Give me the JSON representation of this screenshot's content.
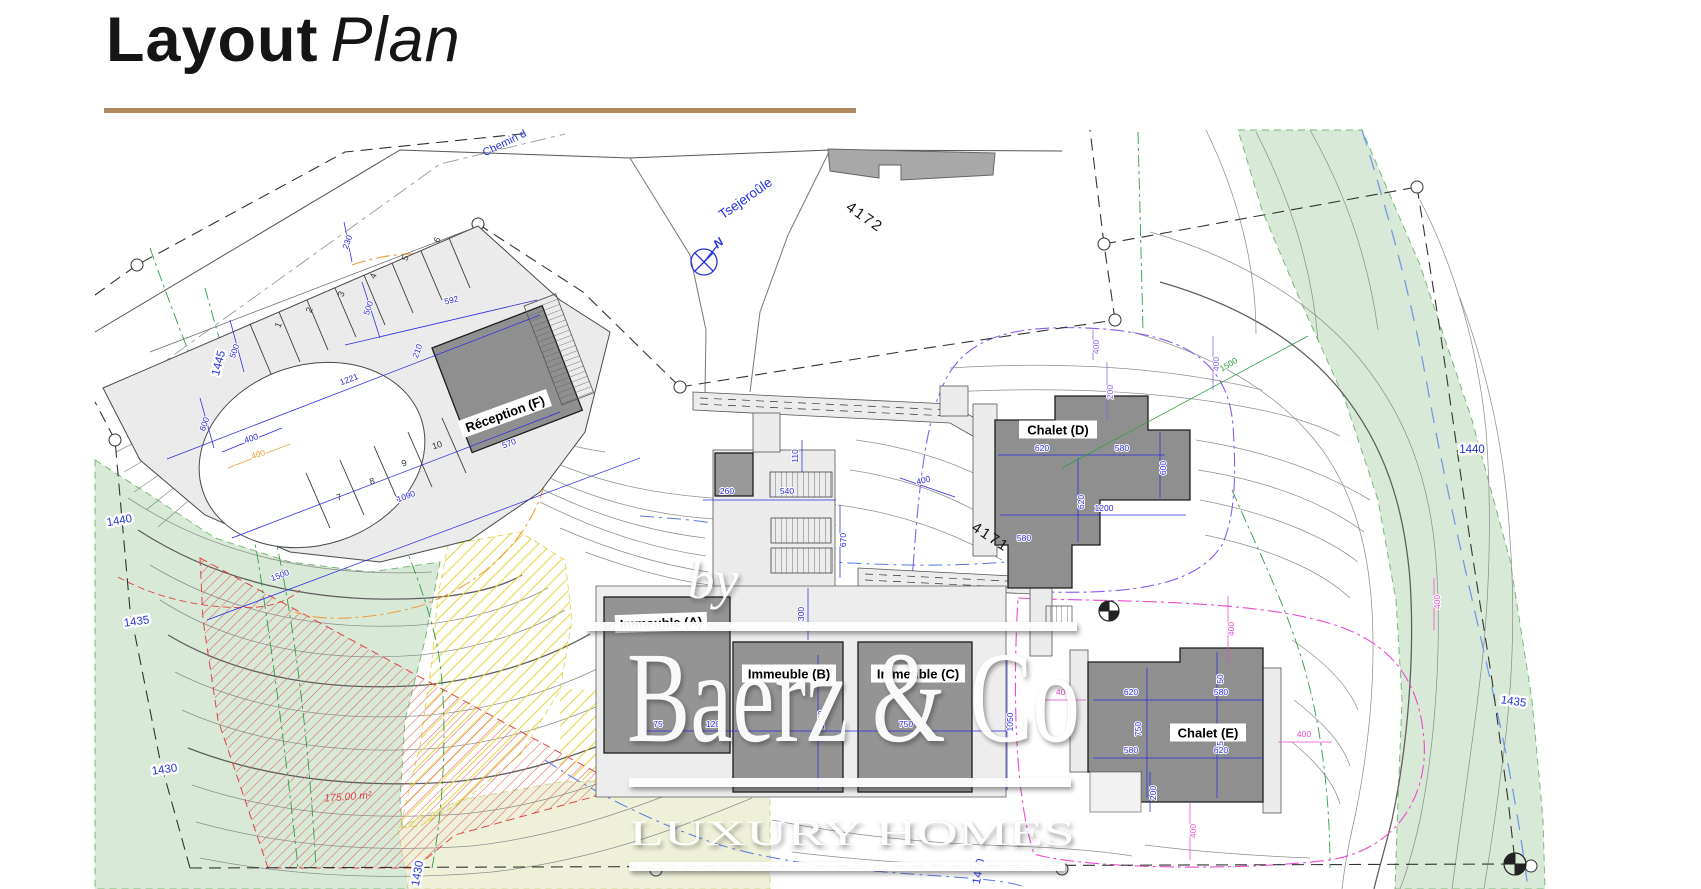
{
  "title": {
    "main": "Layout",
    "sub": "Plan"
  },
  "watermark": {
    "by": "by",
    "name": "Baerz & Co",
    "tagline": "LUXURY HOMES"
  },
  "map": {
    "street_label": "Chemin d",
    "place_label": "Tsejeroûle",
    "compass_label": "N",
    "area_label": "175.00 m²",
    "parcel_numbers": [
      {
        "t": "4172",
        "x": 862,
        "y": 221,
        "r": 35
      },
      {
        "t": "4171",
        "x": 988,
        "y": 541,
        "r": 33
      }
    ],
    "building_labels": [
      {
        "t": "Réception (F)",
        "x": 505,
        "y": 414,
        "r": -20,
        "w": 94
      },
      {
        "t": "Chalet (D)",
        "x": 1058,
        "y": 430,
        "r": 0,
        "w": 78
      },
      {
        "t": "Chalet (E)",
        "x": 1208,
        "y": 733,
        "r": 0,
        "w": 76
      },
      {
        "t": "Immeuble (A)",
        "x": 661,
        "y": 623,
        "r": -2,
        "w": 92
      },
      {
        "t": "Immeuble (B)",
        "x": 789,
        "y": 674,
        "r": 0,
        "w": 94
      },
      {
        "t": "Immeuble (C)",
        "x": 918,
        "y": 674,
        "r": 0,
        "w": 94
      }
    ],
    "contour_labels": [
      {
        "t": "1445",
        "x": 222,
        "y": 364,
        "r": -75
      },
      {
        "t": "1440",
        "x": 120,
        "y": 524,
        "r": -10
      },
      {
        "t": "1435",
        "x": 137,
        "y": 625,
        "r": -8
      },
      {
        "t": "1430",
        "x": 165,
        "y": 773,
        "r": -8
      },
      {
        "t": "1440",
        "x": 1472,
        "y": 453,
        "r": 0
      },
      {
        "t": "1435",
        "x": 1513,
        "y": 705,
        "r": 8
      },
      {
        "t": "1430",
        "x": 421,
        "y": 874,
        "r": -80
      },
      {
        "t": "1430",
        "x": 982,
        "y": 872,
        "r": -80
      }
    ],
    "stall_numbers": [
      {
        "t": "1",
        "x": 281,
        "y": 326,
        "r": -68
      },
      {
        "t": "2",
        "x": 312,
        "y": 311,
        "r": -68
      },
      {
        "t": "3",
        "x": 344,
        "y": 295,
        "r": -68
      },
      {
        "t": "4",
        "x": 376,
        "y": 277,
        "r": -68
      },
      {
        "t": "5",
        "x": 408,
        "y": 259,
        "r": -68
      },
      {
        "t": "6",
        "x": 440,
        "y": 241,
        "r": -68
      },
      {
        "t": "7",
        "x": 340,
        "y": 500,
        "r": -18
      },
      {
        "t": "8",
        "x": 373,
        "y": 484,
        "r": -18
      },
      {
        "t": "9",
        "x": 405,
        "y": 466,
        "r": -18
      },
      {
        "t": "10",
        "x": 438,
        "y": 448,
        "r": -18
      }
    ],
    "dimensions": [
      {
        "t": "500",
        "x": 237,
        "y": 352,
        "r": -70
      },
      {
        "t": "600",
        "x": 207,
        "y": 425,
        "r": -70
      },
      {
        "t": "400",
        "x": 252,
        "y": 441,
        "r": -18
      },
      {
        "t": "400",
        "x": 259,
        "y": 457,
        "r": -18,
        "c": "o"
      },
      {
        "t": "500",
        "x": 371,
        "y": 309,
        "r": -70
      },
      {
        "t": "230",
        "x": 350,
        "y": 243,
        "r": -70
      },
      {
        "t": "592",
        "x": 452,
        "y": 303,
        "r": -13
      },
      {
        "t": "1221",
        "x": 350,
        "y": 382,
        "r": -21
      },
      {
        "t": "210",
        "x": 420,
        "y": 352,
        "r": -70
      },
      {
        "t": "1090",
        "x": 407,
        "y": 499,
        "r": -21
      },
      {
        "t": "570",
        "x": 510,
        "y": 446,
        "r": -21
      },
      {
        "t": "1500",
        "x": 281,
        "y": 578,
        "r": -21
      },
      {
        "t": "110",
        "x": 798,
        "y": 456,
        "r": -90
      },
      {
        "t": "260",
        "x": 727,
        "y": 494,
        "r": 0
      },
      {
        "t": "540",
        "x": 787,
        "y": 494,
        "r": 0
      },
      {
        "t": "670",
        "x": 846,
        "y": 540,
        "r": -90
      },
      {
        "t": "300",
        "x": 804,
        "y": 614,
        "r": -90
      },
      {
        "t": "1050",
        "x": 824,
        "y": 720,
        "r": -90
      },
      {
        "t": "1050",
        "x": 1013,
        "y": 722,
        "r": -90
      },
      {
        "t": "75",
        "x": 658,
        "y": 727,
        "r": 0
      },
      {
        "t": "120",
        "x": 713,
        "y": 727,
        "r": 0
      },
      {
        "t": "750",
        "x": 906,
        "y": 727,
        "r": 0
      },
      {
        "t": "620",
        "x": 1042,
        "y": 451,
        "r": 0
      },
      {
        "t": "580",
        "x": 1122,
        "y": 451,
        "r": 0
      },
      {
        "t": "1200",
        "x": 1104,
        "y": 511,
        "r": 0
      },
      {
        "t": "600",
        "x": 1166,
        "y": 468,
        "r": -90
      },
      {
        "t": "620",
        "x": 1084,
        "y": 502,
        "r": -90
      },
      {
        "t": "580",
        "x": 1024,
        "y": 541,
        "r": 0
      },
      {
        "t": "400",
        "x": 924,
        "y": 483,
        "r": -14
      },
      {
        "t": "200",
        "x": 1113,
        "y": 392,
        "r": -90,
        "c": "p"
      },
      {
        "t": "400",
        "x": 1099,
        "y": 347,
        "r": -90,
        "c": "p"
      },
      {
        "t": "400",
        "x": 1219,
        "y": 364,
        "r": -90,
        "c": "p"
      },
      {
        "t": "620",
        "x": 1131,
        "y": 695,
        "r": 0
      },
      {
        "t": "580",
        "x": 1221,
        "y": 695,
        "r": 0
      },
      {
        "t": "580",
        "x": 1131,
        "y": 753,
        "r": 0
      },
      {
        "t": "620",
        "x": 1221,
        "y": 753,
        "r": 0
      },
      {
        "t": "750",
        "x": 1141,
        "y": 729,
        "r": -90
      },
      {
        "t": "50",
        "x": 1223,
        "y": 679,
        "r": -90
      },
      {
        "t": "50",
        "x": 1223,
        "y": 741,
        "r": -90
      },
      {
        "t": "200",
        "x": 1156,
        "y": 793,
        "r": -90
      },
      {
        "t": "400",
        "x": 1234,
        "y": 629,
        "r": -90,
        "c": "m"
      },
      {
        "t": "400",
        "x": 1304,
        "y": 737,
        "r": 0,
        "c": "m"
      },
      {
        "t": "400",
        "x": 1196,
        "y": 831,
        "r": -90,
        "c": "m"
      },
      {
        "t": "400",
        "x": 1063,
        "y": 695,
        "r": 0,
        "c": "m"
      },
      {
        "t": "400",
        "x": 1440,
        "y": 602,
        "r": -90,
        "c": "m"
      },
      {
        "t": "1500",
        "x": 1230,
        "y": 367,
        "r": -30,
        "c": "g"
      }
    ]
  },
  "colors": {
    "accent_rule": "#b08a5e",
    "dim_blue": "#2a2ae0",
    "dim_purple": "#8a5cf0",
    "dim_magenta": "#e84bd0",
    "dim_green": "#2f9e44",
    "dim_orange": "#ef9f3f",
    "label_blue": "#2233dd",
    "hatch_red": "#e05555",
    "green_area": "#d9e9d7",
    "pale_area": "#eef0d8"
  }
}
